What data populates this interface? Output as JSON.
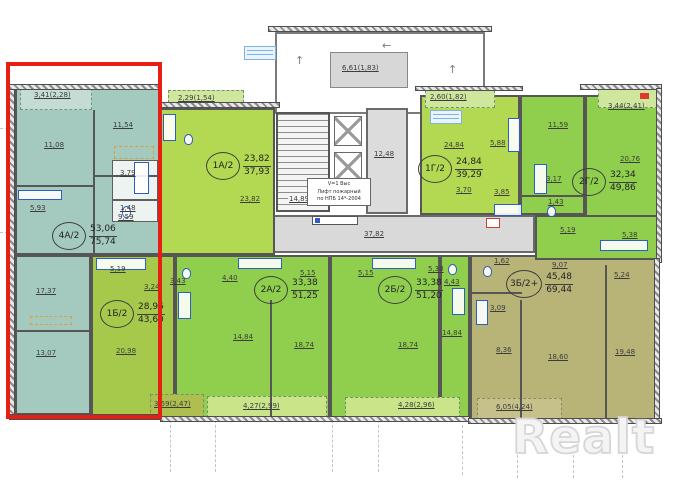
{
  "watermark": "Realt",
  "units": [
    {
      "name": "4А/2",
      "living": "53,06",
      "total": "75,74"
    },
    {
      "name": "1Б/2",
      "living": "28,96",
      "total": "43,60"
    },
    {
      "name": "1А/2",
      "living": "23,82",
      "total": "37,93"
    },
    {
      "name": "2А/2",
      "living": "33,38",
      "total": "51,25"
    },
    {
      "name": "2Б/2",
      "living": "33,38",
      "total": "51,20"
    },
    {
      "name": "1Г/2",
      "living": "24,84",
      "total": "39,29"
    },
    {
      "name": "3Б/2+",
      "living": "45,48",
      "total": "69,44"
    },
    {
      "name": "2Г/2",
      "living": "32,34",
      "total": "49,86"
    }
  ],
  "areas": {
    "a4": [
      "3,41(2,28)",
      "11,08",
      "5,93",
      "11,54",
      "3,79",
      "1,48",
      "9,59",
      "17,37",
      "13,07"
    ],
    "b1": [
      "5,19",
      "3,24",
      "20,98",
      "3,59(2,47)"
    ],
    "a1": [
      "2,29(1,54)",
      "23,82",
      "3,43",
      "4,40"
    ],
    "a2": [
      "5,15",
      "14,84",
      "18,74",
      "4,27(2,99)"
    ],
    "b2": [
      "5,15",
      "5,38",
      "4,43",
      "18,74",
      "14,84",
      "4,28(2,96)"
    ],
    "g1": [
      "2,60(1,82)",
      "24,84",
      "5,88",
      "3,70",
      "3,85"
    ],
    "b3": [
      "1,62",
      "9,07",
      "5,24",
      "3,09",
      "8,36",
      "18,60",
      "19,48",
      "6,05(4,24)"
    ],
    "g2": [
      "3,44(2,41)",
      "11,59",
      "20,76",
      "3,17",
      "1,43",
      "5,19",
      "5,38"
    ]
  },
  "core": {
    "shaft": "6,61(1,83)",
    "stairs": "14,89",
    "lobby": "12,48",
    "corridor": "37,82",
    "note1": "V=1 Выс",
    "note2": "Лифт пожарный",
    "note3": "по НПБ 14*-2004"
  }
}
